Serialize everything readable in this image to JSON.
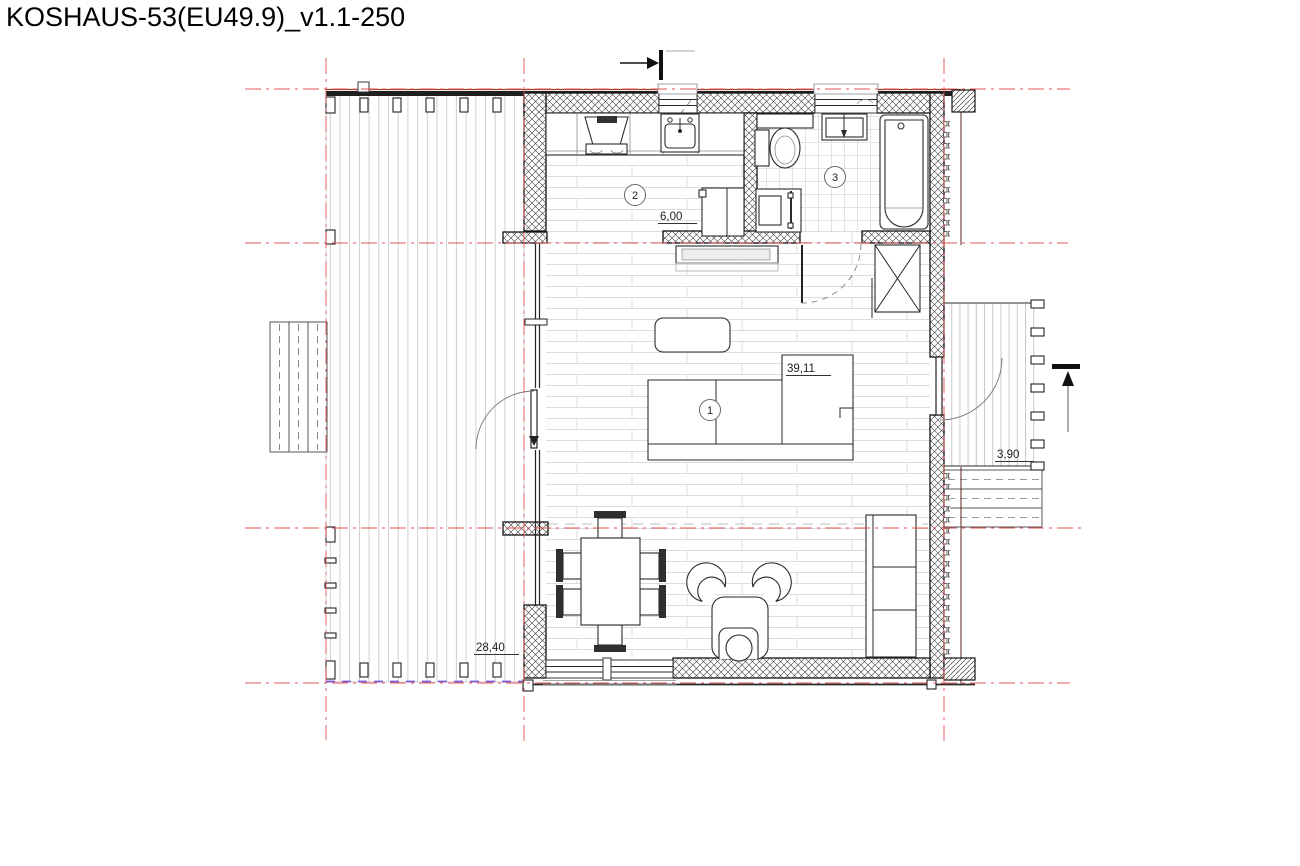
{
  "title": "KOSHAUS-53(EU49.9)_v1.1-250",
  "plan": {
    "rooms": [
      {
        "number": "1",
        "area_label": "39,11"
      },
      {
        "number": "2",
        "area_label": "6,00"
      },
      {
        "number": "3",
        "area_label": ""
      }
    ],
    "dimensions": {
      "living_area": "39,11",
      "kitchen_area": "6,00",
      "terrace_left_area": "28,40",
      "terrace_right_area": "3,90"
    },
    "icons": {
      "section_cut_top": "section-arrow-right-into-bar",
      "section_cut_right": "section-arrow-up-into-bar"
    },
    "colors": {
      "grid_line": "#e25555",
      "roof_edge": "#a03a2e",
      "terrace_boundary_dashed": "#7e57d9",
      "wall": "#141414"
    }
  }
}
